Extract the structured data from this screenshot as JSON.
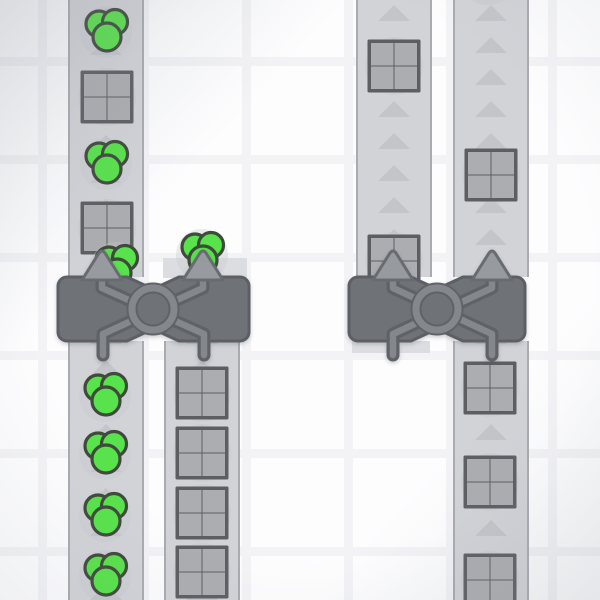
{
  "app": {
    "title": "factory-game-viewport"
  },
  "scene": {
    "width": 600,
    "height": 600,
    "grid": {
      "period_x": 102,
      "period_y": 98,
      "line_thickness": 9,
      "line_offset_x": 38,
      "line_offset_y": 57
    },
    "colors": {
      "background": "#fdfdfe",
      "grid_line": "#f3f3f6",
      "belt_surface": "#d2d3d7",
      "belt_edge": "#a9abb1",
      "belt_arrow": "#c3c5c9",
      "pad": "#dcdde0",
      "item_backdrop": "#c7c9ce",
      "square_frame": "#5c5e62",
      "square_cell": "#acadb0",
      "circle_fill": "#58e24b",
      "circle_stroke": "#3f4a3c",
      "machine_body": "#6f7277",
      "machine_outline": "#5c6065",
      "machine_pipe": "#84888d",
      "machine_pipe_dark": "#5f6368",
      "machine_arrow": "#979a9f",
      "machine_arrow_outline": "#686c71",
      "vignette": "#8a909b"
    },
    "belts": [
      {
        "id": "belt-left-upper",
        "x": 68,
        "y": 0,
        "w": 76,
        "h": 277,
        "direction": "up",
        "arrow_phase": 7,
        "arrow_gap": 32
      },
      {
        "id": "belt-left-lower",
        "x": 68,
        "y": 341,
        "w": 76,
        "h": 259,
        "direction": "up",
        "arrow_phase": 19,
        "arrow_gap": 32
      },
      {
        "id": "belt-left2-lower",
        "x": 164,
        "y": 341,
        "w": 76,
        "h": 259,
        "direction": "up",
        "arrow_phase": 19,
        "arrow_gap": 32
      },
      {
        "id": "belt-right1-upper",
        "x": 356,
        "y": 0,
        "w": 76,
        "h": 277,
        "direction": "up",
        "arrow_phase": 5,
        "arrow_gap": 32
      },
      {
        "id": "belt-right2-upper",
        "x": 453,
        "y": 0,
        "w": 76,
        "h": 277,
        "direction": "up",
        "arrow_phase": 5,
        "arrow_gap": 32
      },
      {
        "id": "belt-right2-lower",
        "x": 453,
        "y": 341,
        "w": 76,
        "h": 259,
        "direction": "up",
        "arrow_phase": 19,
        "arrow_gap": 32
      }
    ],
    "pads": [
      {
        "id": "pad-left-machine-top-output",
        "x": 163,
        "y": 258,
        "w": 84,
        "h": 20
      },
      {
        "id": "pad-right-machine-bottom-input",
        "x": 352,
        "y": 341,
        "w": 78,
        "h": 12
      }
    ],
    "items": [
      {
        "type": "circles",
        "x": 106,
        "y": 31
      },
      {
        "type": "square",
        "x": 107,
        "y": 97
      },
      {
        "type": "circles",
        "x": 106,
        "y": 163
      },
      {
        "type": "square",
        "x": 107,
        "y": 228
      },
      {
        "type": "circles",
        "x": 116,
        "y": 267
      },
      {
        "type": "circles",
        "x": 202,
        "y": 254
      },
      {
        "type": "circles",
        "x": 105,
        "y": 395
      },
      {
        "type": "circles",
        "x": 105,
        "y": 453
      },
      {
        "type": "circles",
        "x": 105,
        "y": 515
      },
      {
        "type": "circles",
        "x": 105,
        "y": 575
      },
      {
        "type": "square",
        "x": 202,
        "y": 393
      },
      {
        "type": "square",
        "x": 202,
        "y": 453
      },
      {
        "type": "square",
        "x": 202,
        "y": 513
      },
      {
        "type": "square",
        "x": 202,
        "y": 572
      },
      {
        "type": "square",
        "x": 394,
        "y": 66
      },
      {
        "type": "square",
        "x": 394,
        "y": 261
      },
      {
        "type": "square",
        "x": 491,
        "y": 175
      },
      {
        "type": "backdrop",
        "x": 488,
        "y": -24
      },
      {
        "type": "square",
        "x": 490,
        "y": 388
      },
      {
        "type": "square",
        "x": 490,
        "y": 482
      },
      {
        "type": "square",
        "x": 490,
        "y": 580
      }
    ],
    "machines": [
      {
        "id": "balancer-left",
        "x": 58,
        "y": 277,
        "w": 191,
        "h": 64,
        "outputs_x": [
          102,
          203
        ],
        "inputs_x": [
          103,
          204
        ],
        "ring_x": 153
      },
      {
        "id": "balancer-right",
        "x": 349,
        "y": 277,
        "w": 176,
        "h": 64,
        "outputs_x": [
          393,
          492
        ],
        "inputs_x": [
          393,
          492
        ],
        "ring_x": 437
      }
    ]
  }
}
